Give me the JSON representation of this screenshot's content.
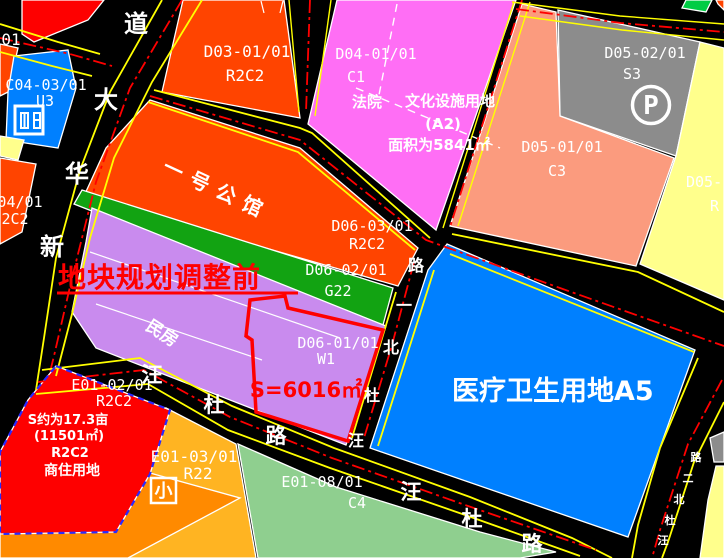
{
  "colors": {
    "road": "#000000",
    "red": "#fe0000",
    "orange_red": "#ff4400",
    "pink": "#ff6ef5",
    "blue": "#0080ff",
    "grey": "#8c8c8c",
    "salmon": "#fb9b7e",
    "light_yellow": "#ffff8c",
    "purple": "#c98bee",
    "green_strip": "#12a312",
    "sage_green": "#8fcf8f",
    "amber": "#ffb422",
    "dark_orange": "#ff8a00",
    "bright_green": "#00cc44",
    "line_yellow": "#ffff00",
    "line_red": "#ff0000",
    "annotation_red": "#ff0000"
  },
  "annotations": {
    "before_adjust": "地块规划调整前",
    "plot_area": "S=6016㎡",
    "road_label_fragment": "01"
  },
  "parcels": {
    "c04_03": {
      "code": "C04-03/01",
      "cls": "U3"
    },
    "c04_04": {
      "code_fragment": "04/01",
      "cls_fragment": "2C2"
    },
    "d03_01": {
      "code": "D03-01/01",
      "cls": "R2C2"
    },
    "d04_01": {
      "code": "D04-01/01",
      "cls": "C1",
      "occupant": "法院",
      "use": "文化设施用地",
      "use_code": "(A2)",
      "area": "面积为5841㎡"
    },
    "d05_02": {
      "code": "D05-02/01",
      "cls": "S3",
      "icon_letter": "P"
    },
    "d05_01": {
      "code": "D05-01/01",
      "cls": "C3"
    },
    "d05_right": {
      "code_fragment": "D05-",
      "cls_fragment": "R"
    },
    "yihao": {
      "name": "一号公馆"
    },
    "d06_03": {
      "code": "D06-03/01",
      "cls": "R2C2"
    },
    "d06_02": {
      "code": "D06-02/01",
      "cls": "G22"
    },
    "d06_01": {
      "code": "D06-01/01",
      "cls": "W1"
    },
    "minfang": {
      "name": "民房"
    },
    "a5": {
      "name": "医疗卫生用地A5"
    },
    "e01_02": {
      "code": "E01-02/01",
      "cls": "R2C2",
      "area_mu": "S约为17.3亩",
      "area_m2": "(11501㎡)",
      "cls2": "R2C2",
      "use": "商住用地"
    },
    "e01_03": {
      "code": "E01-03/01",
      "cls": "R22",
      "icon_char": "小"
    },
    "e01_08": {
      "code": "E01-08/01",
      "cls": "C4"
    }
  },
  "roads": {
    "xinhua_avenue": {
      "name": "新华大道",
      "chars": [
        "道",
        "大",
        "华",
        "新"
      ]
    },
    "wangdu_north1": {
      "name": "汪杜北一路",
      "chars": [
        "路",
        "一",
        "北",
        "杜",
        "汪"
      ]
    },
    "wangdu_north2": {
      "name": "汪杜北二路",
      "chars": [
        "路",
        "二",
        "北",
        "杜",
        "汪"
      ]
    },
    "wangdu_road": {
      "name": "汪杜路",
      "chars": [
        "汪",
        "杜",
        "路"
      ]
    }
  }
}
